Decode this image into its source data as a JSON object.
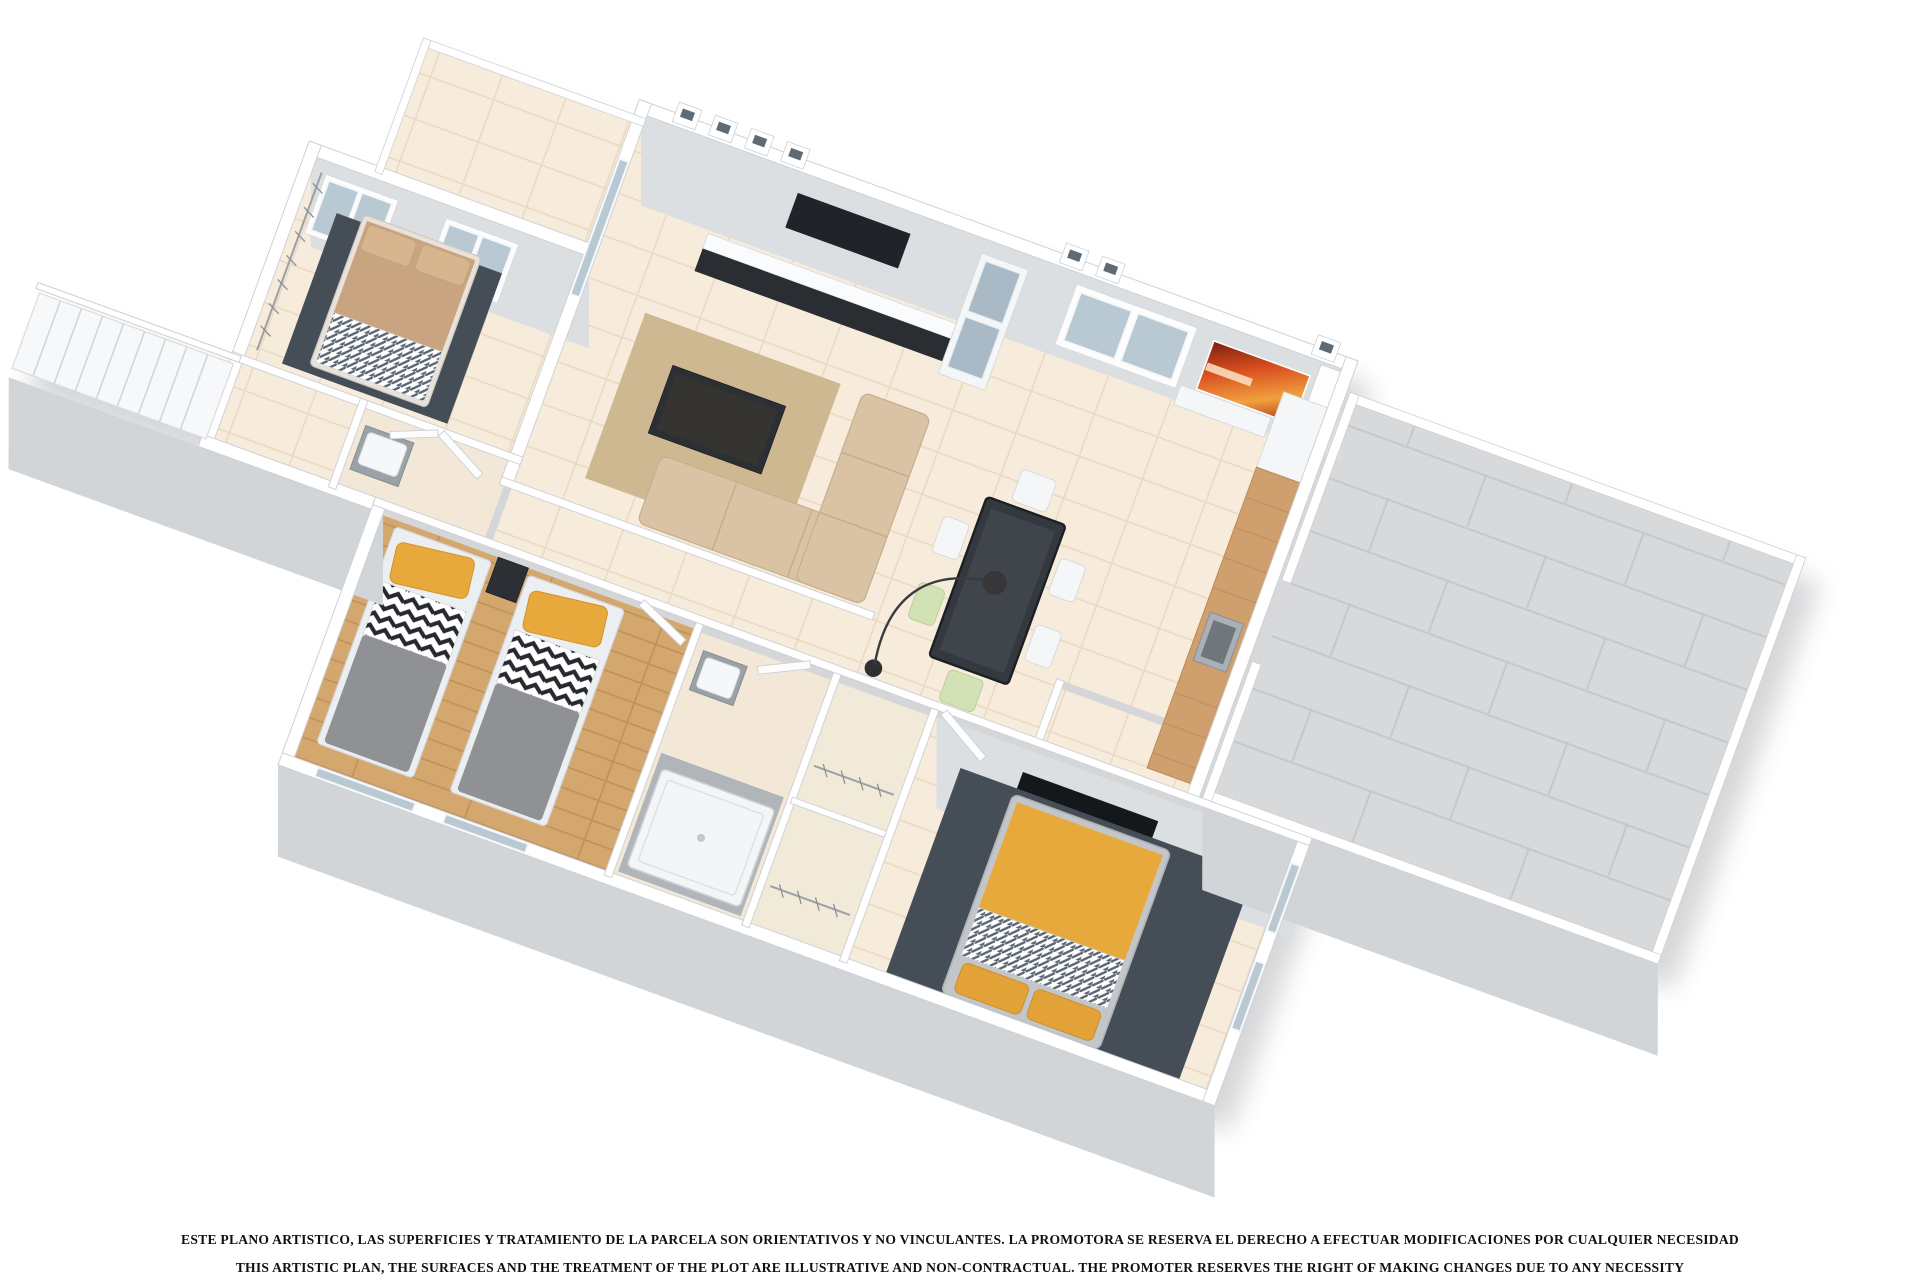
{
  "scene": {
    "type": "3d-floor-plan-render",
    "description": "Isometric 3D render of an apartment floor plan with three bedrooms, two bathrooms, living-dining room, kitchen and two terraces"
  },
  "disclaimer": {
    "line1": "ESTE PLANO ARTISTICO, LAS SUPERFICIES Y TRATAMIENTO DE LA PARCELA SON ORIENTATIVOS Y NO VINCULANTES. LA PROMOTORA SE RESERVA EL DERECHO A EFECTUAR MODIFICACIONES POR CUALQUIER NECESIDAD",
    "line2": "THIS ARTISTIC PLAN, THE SURFACES AND THE TREATMENT OF THE PLOT ARE ILLUSTRATIVE AND NON-CONTRACTUAL. THE PROMOTER RESERVES THE RIGHT OF MAKING CHANGES DUE TO ANY NECESSITY"
  },
  "palette": {
    "bg": "#ffffff",
    "wall": "#ffffff",
    "wall-edge": "#cdd1d5",
    "face": "#dcdfe1",
    "face-dark": "#d2d5d8",
    "floor-beige": "#f7ecdb",
    "floor-beige-line": "#ead9c3",
    "wood-floor": "#d4a76e",
    "gray-tile": "#d7d9db",
    "gray-tile-line": "#c5c8cb",
    "rug-dark": "#454d56",
    "rug-beige": "#cdb892",
    "sofa": "#d9c3a4",
    "dark-furniture": "#2c2f33",
    "tv-black": "#1b1e21",
    "glass": "#b9c9d3",
    "orange": "#e7a93c",
    "duvet": "#8f9194",
    "green-chair": "#d3e2b4",
    "wood-counter": "#cf9f6e",
    "painting-red": "#d84e1f",
    "painting-amber": "#f2a03f",
    "text": "#101010"
  }
}
